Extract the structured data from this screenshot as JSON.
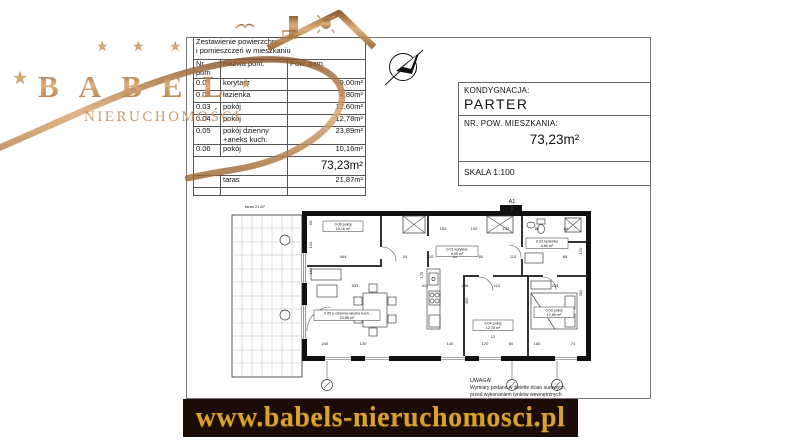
{
  "branding": {
    "logo_text": "BABEL",
    "logo_subtext": "NIERUCHOMOŚCI",
    "website": "www.babels-nieruchomosci.pl",
    "star": "★",
    "copper": "#b5763f",
    "gold": "#d9a32a",
    "band_bg": "#1b0d06"
  },
  "area_table": {
    "title_line1": "Zestawienie powierzchni",
    "title_line2": "i pomieszczeń w mieszkaniu",
    "columns": [
      "Nr pom",
      "Nazwa pom.",
      "Pow. pom."
    ],
    "rows": [
      {
        "nr": "0.01",
        "name": "korytarz",
        "area": "9,00m²"
      },
      {
        "nr": "0.02",
        "name": "łazienka",
        "area": "4,80m²"
      },
      {
        "nr": "0.03",
        "name": "pokój",
        "area": "12,60m²"
      },
      {
        "nr": "0.04",
        "name": "pokój",
        "area": "12,78m²"
      },
      {
        "nr": "0.05",
        "name": "pokój dzienny +aneks kuch.",
        "area": "23,89m²"
      },
      {
        "nr": "0.06",
        "name": "pokój",
        "area": "10,16m²"
      }
    ],
    "total_area": "73,23m²",
    "terrace_row": {
      "nr": "",
      "name": "taras",
      "area": "21,87m²"
    }
  },
  "title_block": {
    "storey_label": "KONDYGNACJA:",
    "storey_value": "PARTER",
    "apartment_area_label": "NR. POW. MIESZKANIA:",
    "apartment_area_value": "73,23m²",
    "scale_label": "SKALA 1:100"
  },
  "plan": {
    "axis_label": "A1",
    "note_title": "UWAGA!",
    "note_line1": "Wymiary podano w świetle ścian surowych,",
    "note_line2": "przed wykonaniem tynków wewnętrznych",
    "room_labels": [
      {
        "l1": "0.06 pokój",
        "l2": "10,16 m²",
        "x": 118,
        "y": 31,
        "w": 40
      },
      {
        "l1": "0.01 korytarz",
        "l2": "9,00 m²",
        "x": 232,
        "y": 56,
        "w": 42
      },
      {
        "l1": "0.02 łazienka",
        "l2": "4,80 m²",
        "x": 322,
        "y": 48,
        "w": 42
      },
      {
        "l1": "0.05 p.dzienny+aneks kuch.",
        "l2": "23,89 m²",
        "x": 122,
        "y": 120,
        "w": 66
      },
      {
        "l1": "0.04 pokój",
        "l2": "12,78 m²",
        "x": 268,
        "y": 130,
        "w": 40
      },
      {
        "l1": "0.03 pokój",
        "l2": "12,60 m²",
        "x": 329,
        "y": 117,
        "w": 40
      }
    ],
    "annotations": [
      {
        "x": 30,
        "y": 13,
        "t": "taras 21,87"
      },
      {
        "x": 218,
        "y": 35,
        "t": "154"
      },
      {
        "x": 249,
        "y": 35,
        "t": "100"
      },
      {
        "x": 281,
        "y": 35,
        "t": "132"
      },
      {
        "x": 312,
        "y": 35,
        "t": "80"
      },
      {
        "x": 341,
        "y": 35,
        "t": "64"
      },
      {
        "x": 118,
        "y": 63,
        "t": "444"
      },
      {
        "x": 180,
        "y": 63,
        "t": "24"
      },
      {
        "x": 205,
        "y": 63,
        "t": "120"
      },
      {
        "x": 230,
        "y": 63,
        "t": "64"
      },
      {
        "x": 256,
        "y": 63,
        "t": "80"
      },
      {
        "x": 288,
        "y": 63,
        "t": "110"
      },
      {
        "x": 340,
        "y": 63,
        "t": "68"
      },
      {
        "x": 130,
        "y": 92,
        "t": "533"
      },
      {
        "x": 200,
        "y": 92,
        "t": "412"
      },
      {
        "x": 240,
        "y": 92,
        "t": "296"
      },
      {
        "x": 272,
        "y": 92,
        "t": "110"
      },
      {
        "x": 330,
        "y": 92,
        "t": "234"
      },
      {
        "x": 100,
        "y": 150,
        "t": "246"
      },
      {
        "x": 138,
        "y": 150,
        "t": "130"
      },
      {
        "x": 225,
        "y": 150,
        "t": "140"
      },
      {
        "x": 260,
        "y": 150,
        "t": "120"
      },
      {
        "x": 286,
        "y": 150,
        "t": "60"
      },
      {
        "x": 312,
        "y": 150,
        "t": "180"
      },
      {
        "x": 348,
        "y": 150,
        "t": "74"
      },
      {
        "x": 87,
        "y": 28,
        "t": "50",
        "rot": 1
      },
      {
        "x": 87,
        "y": 50,
        "t": "120",
        "rot": 1
      },
      {
        "x": 87,
        "y": 76,
        "t": "162",
        "rot": 1
      },
      {
        "x": 198,
        "y": 80,
        "t": "175",
        "rot": 1
      },
      {
        "x": 243,
        "y": 106,
        "t": "462",
        "rot": 1
      },
      {
        "x": 357,
        "y": 98,
        "t": "302",
        "rot": 1
      },
      {
        "x": 357,
        "y": 56,
        "t": "120",
        "rot": 1
      },
      {
        "x": 268,
        "y": 143,
        "t": "12"
      }
    ]
  }
}
